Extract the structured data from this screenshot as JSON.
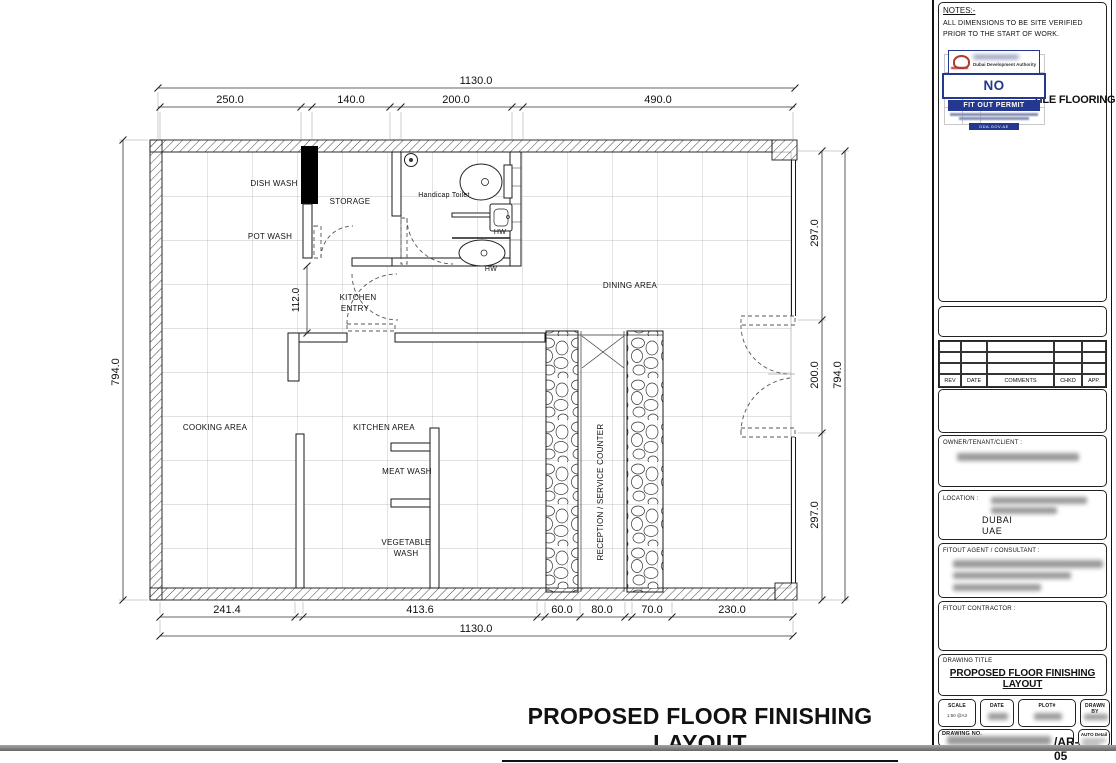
{
  "sheet": {
    "main_title": "PROPOSED FLOOR FINISHING LAYOUT"
  },
  "plan": {
    "rooms": {
      "dish_wash": "DISH WASH",
      "storage": "STORAGE",
      "pot_wash": "POT WASH",
      "handicap_toilet": "Handicap Toilet",
      "hw_upper": "HW",
      "hw_lower": "HW",
      "kitchen_entry_line1": "KITCHEN",
      "kitchen_entry_line2": "ENTRY",
      "dining_area": "DINING AREA",
      "cooking_area": "COOKING AREA",
      "kitchen_area": "KITCHEN AREA",
      "meat_wash": "MEAT WASH",
      "vegetable_wash_line1": "VEGETABLE",
      "vegetable_wash_line2": "WASH",
      "reception_counter": "RECEPTION / SERVICE COUNTER"
    },
    "dimensions": {
      "top_total": "1130.0",
      "top_segments": [
        "250.0",
        "140.0",
        "200.0",
        "490.0"
      ],
      "bottom_segments": [
        "241.4",
        "413.6",
        "60.0",
        "80.0",
        "70.0",
        "230.0"
      ],
      "bottom_total": "1130.0",
      "left_total": "794.0",
      "right_segments": [
        "297.0",
        "200.0",
        "297.0"
      ],
      "right_total": "794.0",
      "kitchen_entry_width": "112.0"
    }
  },
  "titleblock": {
    "notes_label": "NOTES:-",
    "notes_text": "ALL DIMENSIONS TO BE SITE VERIFIED PRIOR TO THE START OF WORK.",
    "legend_item": "TILE FLOORING",
    "stamp": {
      "authority": "Dubai Development Authority",
      "status": "NO OBJECTION",
      "permit_type": "FIT OUT PERMIT",
      "website": "DDA.GOV.AE",
      "accent_color": "#24388f",
      "logo_color": "#b03a2e"
    },
    "revision_table": {
      "headers": [
        "REV",
        "DATE",
        "COMMENTS",
        "CHKD",
        "APP."
      ]
    },
    "owner_label": "OWNER/TENANT/CLIENT :",
    "location_label": "LOCATION :",
    "location_city": "DUBAI",
    "location_country": "UAE",
    "fitout_agent_label": "FITOUT AGENT / CONSULTANT :",
    "fitout_contractor_label": "FITOUT CONTRACTOR :",
    "drawing_title_label": "DRAWING TITLE",
    "drawing_title": "PROPOSED FLOOR FINISHING LAYOUT",
    "scale_label": "SCALE",
    "scale_value": "1:50 @A3",
    "date_label": "DATE",
    "plot_label": "PLOT#",
    "drawn_by_label": "DRAWN BY",
    "drawing_no_label": "DRAWING NO.",
    "drawing_no_suffix": "/AR-05",
    "auto_detail_label": "AUTO Detail"
  }
}
